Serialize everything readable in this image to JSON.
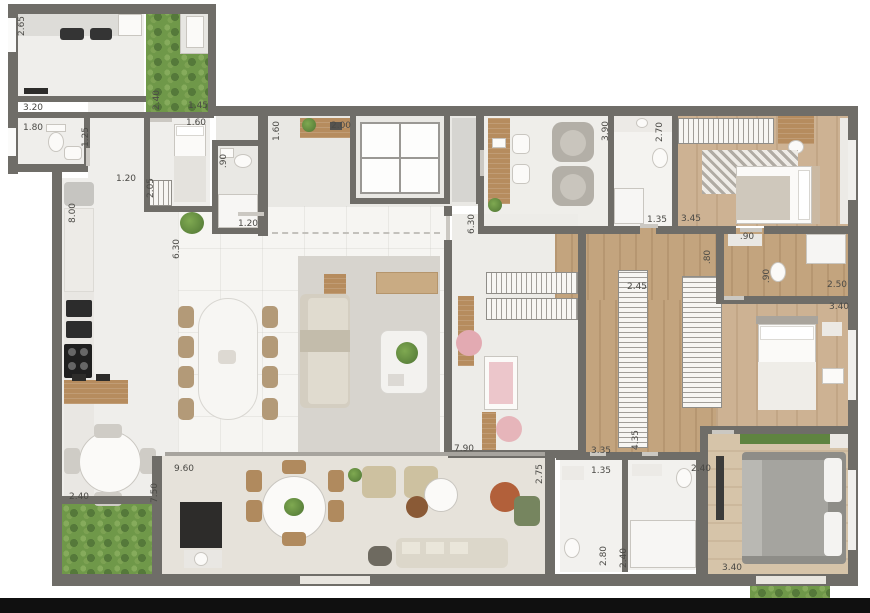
{
  "palette": {
    "wall": "#6f6d68",
    "tile": "#efeeeb",
    "marble": "#f6f5f2",
    "wood": "#cdb293",
    "grass": "#6f9849",
    "rug": "#d7d4ce",
    "pink": "#e3aab2",
    "terracotta": "#b2603a",
    "bed_gray": "#8e8d88"
  },
  "plan": {
    "type": "apartment-floor-plan",
    "dimensions": [
      {
        "label": "2.65",
        "x": 22,
        "y": 26,
        "vertical": true
      },
      {
        "label": "3.20",
        "x": 33,
        "y": 108,
        "vertical": false
      },
      {
        "label": "1.80",
        "x": 33,
        "y": 128,
        "vertical": false
      },
      {
        "label": "1.25",
        "x": 86,
        "y": 137,
        "vertical": true
      },
      {
        "label": "2.40",
        "x": 157,
        "y": 100,
        "vertical": true
      },
      {
        "label": "1.45",
        "x": 198,
        "y": 106,
        "vertical": false
      },
      {
        "label": "1.60",
        "x": 196,
        "y": 123,
        "vertical": false
      },
      {
        "label": "1.60",
        "x": 277,
        "y": 131,
        "vertical": true
      },
      {
        "label": "2.00",
        "x": 341,
        "y": 126,
        "vertical": false
      },
      {
        "label": "2.05",
        "x": 151,
        "y": 188,
        "vertical": true
      },
      {
        "label": ".90",
        "x": 224,
        "y": 161,
        "vertical": true
      },
      {
        "label": "1.20",
        "x": 126,
        "y": 179,
        "vertical": false
      },
      {
        "label": "1.20",
        "x": 248,
        "y": 224,
        "vertical": false
      },
      {
        "label": "8.00",
        "x": 73,
        "y": 213,
        "vertical": true
      },
      {
        "label": "6.30",
        "x": 177,
        "y": 249,
        "vertical": true
      },
      {
        "label": "6.30",
        "x": 472,
        "y": 224,
        "vertical": true
      },
      {
        "label": "3.90",
        "x": 606,
        "y": 131,
        "vertical": true
      },
      {
        "label": "2.70",
        "x": 660,
        "y": 132,
        "vertical": true
      },
      {
        "label": "1.35",
        "x": 657,
        "y": 220,
        "vertical": false
      },
      {
        "label": "3.45",
        "x": 691,
        "y": 219,
        "vertical": false
      },
      {
        "label": ".90",
        "x": 747,
        "y": 237,
        "vertical": false
      },
      {
        "label": ".80",
        "x": 708,
        "y": 257,
        "vertical": true
      },
      {
        "label": ".90",
        "x": 767,
        "y": 276,
        "vertical": true
      },
      {
        "label": "2.50",
        "x": 837,
        "y": 285,
        "vertical": false
      },
      {
        "label": "3.40",
        "x": 839,
        "y": 307,
        "vertical": false
      },
      {
        "label": "2.45",
        "x": 637,
        "y": 287,
        "vertical": false
      },
      {
        "label": "3.35",
        "x": 601,
        "y": 451,
        "vertical": false
      },
      {
        "label": "4.35",
        "x": 636,
        "y": 440,
        "vertical": true
      },
      {
        "label": "1.35",
        "x": 601,
        "y": 471,
        "vertical": false
      },
      {
        "label": "2.40",
        "x": 701,
        "y": 469,
        "vertical": false
      },
      {
        "label": "2.80",
        "x": 604,
        "y": 556,
        "vertical": true
      },
      {
        "label": "2.40",
        "x": 624,
        "y": 558,
        "vertical": true
      },
      {
        "label": "3.40",
        "x": 732,
        "y": 568,
        "vertical": false
      },
      {
        "label": "2.75",
        "x": 540,
        "y": 474,
        "vertical": true
      },
      {
        "label": "7.90",
        "x": 464,
        "y": 449,
        "vertical": false
      },
      {
        "label": "9.60",
        "x": 184,
        "y": 469,
        "vertical": false
      },
      {
        "label": "7.50",
        "x": 155,
        "y": 493,
        "vertical": true
      },
      {
        "label": "2.40",
        "x": 79,
        "y": 497,
        "vertical": false
      }
    ]
  }
}
